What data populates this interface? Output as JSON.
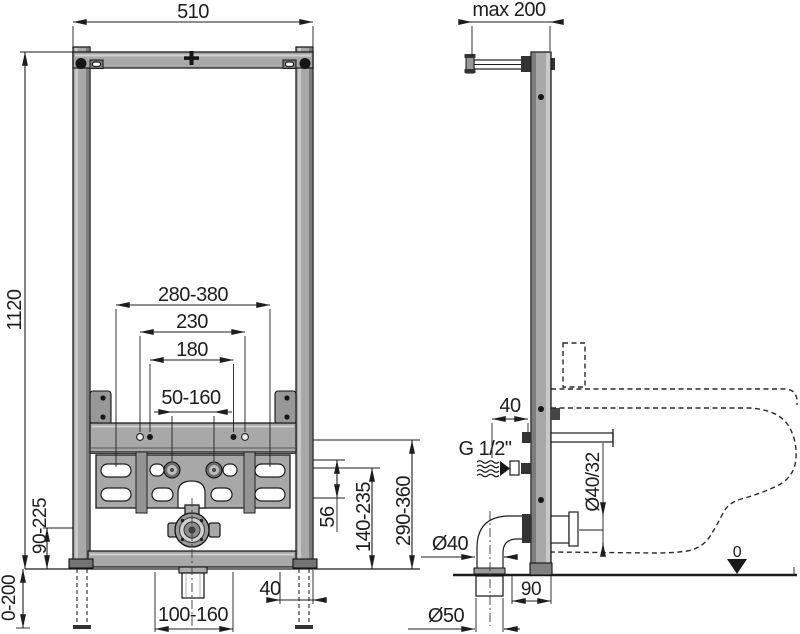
{
  "drawing_type": "installation-frame-technical-drawing",
  "colors": {
    "line": "#1d1d1d",
    "frame_fill": "#a8a8a8",
    "frame_dark": "#7d7d7d",
    "frame_light": "#c9c9c9",
    "metal_dark": "#333333",
    "background": "#ffffff"
  },
  "labels": {
    "front": {
      "frame_width": "510",
      "frame_height": "1120",
      "fixing_width_outer": "280-380",
      "fixing_width_230": "230",
      "fixing_width_180": "180",
      "fixing_slot_range": "50-160",
      "plate_row_gap": "56",
      "bracket_height_range": "140-235",
      "outlet_height_range": "290-360",
      "side_height_range": "90-225",
      "leg_extension_range": "0-200",
      "drain_offset_range": "100-160",
      "foot_depth": "40"
    },
    "side": {
      "wall_distance_max": "max 200",
      "water_offset": "40",
      "water_thread": "G 1/2\"",
      "outlet_pipe_dia": "Ø40/32",
      "elbow_dia": "Ø40",
      "floor_pipe_dia": "Ø50",
      "floor_offset": "90",
      "floor_datum": "0"
    }
  }
}
